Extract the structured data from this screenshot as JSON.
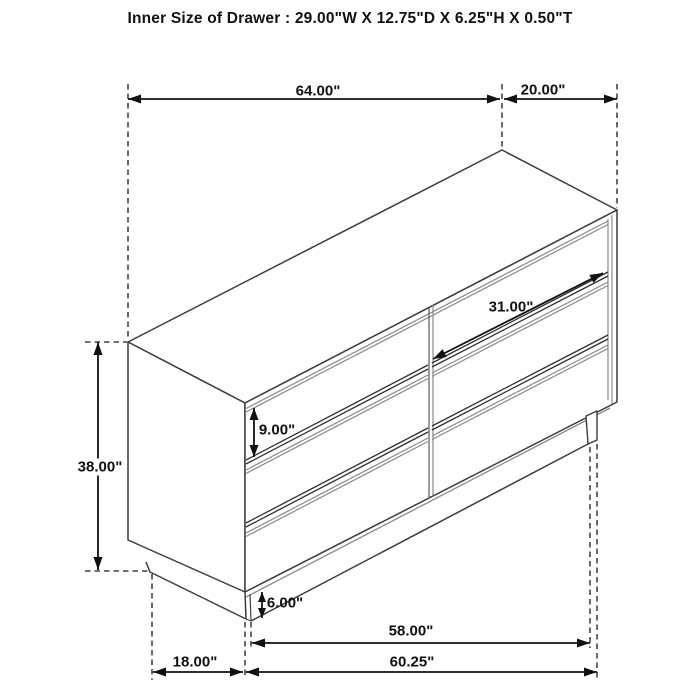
{
  "title": "Inner Size of Drawer : 29.00\"W X 12.75\"D X 6.25\"H X 0.50\"T",
  "dimensions": {
    "top_width": "64.00\"",
    "top_depth": "20.00\"",
    "drawer_opening_width": "31.00\"",
    "drawer_front_height": "9.00\"",
    "overall_height": "38.00\"",
    "base_height": "6.00\"",
    "leg_span_width": "58.00\"",
    "base_width": "60.25\"",
    "base_depth": "18.00\""
  }
}
